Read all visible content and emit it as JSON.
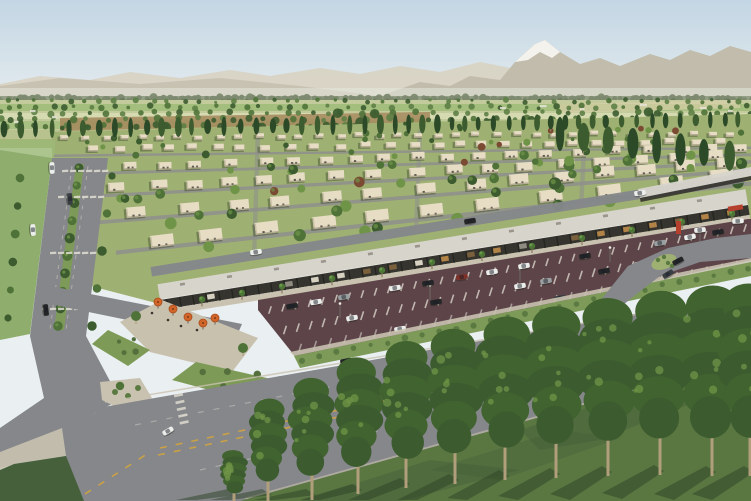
{
  "meta": {
    "title": "Aerial 3D rendering of a master-planned desert community with homes, tree-lined boulevard, retail strip and mountains",
    "type": "architectural-visualization"
  },
  "palette": {
    "sky_top": "#c3d6e3",
    "sky_horizon": "#eaeff1",
    "mtn_far": "#d8d3c4",
    "mtn_near": "#c1bcab",
    "snow": "#f4f2ec",
    "haze": "#e3e7dd",
    "treeline": "#7d8a6f",
    "treeline_dark": "#6d7c60",
    "field_light": "#c3cb9c",
    "field_green": "#9cba77",
    "field_pale": "#d8dcb4",
    "field_tan": "#d8cfa9",
    "field_brown": "#a3875c",
    "lawn": "#9fb172",
    "tree_dark": "#3c5c30",
    "tree_mid": "#4f7239",
    "tree_light": "#6f9447",
    "tree_red": "#7a4a33",
    "house": "#e7ddc5",
    "house_shade": "#b5ab92",
    "house_wall": "#c9bfa6",
    "opening": "#4b4a40",
    "street": "#8f918b",
    "road": "#85878a",
    "road_dark": "#74767a",
    "sidewalk": "#c9c2b0",
    "plaza": "#c8c1ae",
    "lane_yellow": "#d2a43e",
    "marking_white": "#e2ded2",
    "roof": "#d7d4cc",
    "roof_edge": "#ecebe3",
    "fascia": "#35342f",
    "column": "#23231f",
    "glow": "#bf8c4a",
    "parking": "#5d4449",
    "median_green": "#7d9a58",
    "shrub": "#5b7a42",
    "shrub_bed": "#7e9a57",
    "grass_fg": "#5a7742",
    "grass_fg_dark": "#45603a",
    "shadow_green": "#2c4123",
    "umbrella": "#d2662a",
    "umbrella_dark": "#a84d1d",
    "trunk": "#b19f7c",
    "palm_green": "#4d7636",
    "pole": "#d8d8d0",
    "car_white": "#eceeec",
    "car_black": "#232526",
    "car_gray": "#9aa0a2",
    "car_red": "#7e3129",
    "car_slate": "#3a3f44",
    "monument_red": "#b5402e",
    "people": "#3a352e"
  },
  "scene": {
    "house_rows": [
      {
        "y": 135,
        "x0": 60,
        "x1": 748,
        "w": 8,
        "h": 4.5,
        "slope": -0.006
      },
      {
        "y": 146,
        "x0": 88,
        "x1": 748,
        "w": 10,
        "h": 6,
        "slope": -0.012
      },
      {
        "y": 163,
        "x0": 92,
        "x1": 748,
        "w": 13,
        "h": 7.5,
        "slope": -0.03
      },
      {
        "y": 184,
        "x0": 108,
        "x1": 748,
        "w": 16,
        "h": 9,
        "slope": -0.055
      },
      {
        "y": 208,
        "x0": 126,
        "x1": 748,
        "w": 19,
        "h": 10.5,
        "slope": -0.085
      },
      {
        "y": 236,
        "x0": 150,
        "x1": 742,
        "w": 23,
        "h": 12,
        "slope": -0.115
      }
    ],
    "cross_streets": [
      258,
      420,
      585
    ],
    "yard_tree_count": 85,
    "poplar_rows": [
      {
        "x0": 4,
        "x1": 445,
        "y": 129,
        "dydx": -0.012,
        "step": 13,
        "rx": 2.8,
        "ry": 8.5
      },
      {
        "x0": 452,
        "x1": 748,
        "y": 124,
        "dydx": -0.016,
        "step": 12,
        "rx": 2.6,
        "ry": 7
      },
      {
        "x0": 560,
        "x1": 748,
        "y": 134,
        "dydx": 0.128,
        "step": 23,
        "rx": 4.6,
        "ry": 15
      }
    ],
    "parking_rows": [
      {
        "x0": 270,
        "y0": 310,
        "x1": 745,
        "y1": 228,
        "stripes": 36,
        "len": 8
      },
      {
        "x0": 285,
        "y0": 330,
        "x1": 748,
        "y1": 244,
        "stripes": 36,
        "len": 9
      },
      {
        "x0": 300,
        "y0": 348,
        "x1": 751,
        "y1": 262,
        "stripes": 30,
        "len": 9
      }
    ],
    "parked_cars": [
      {
        "x": 292,
        "y": 306,
        "c": "car_black"
      },
      {
        "x": 316,
        "y": 302,
        "c": "car_white"
      },
      {
        "x": 344,
        "y": 297,
        "c": "car_gray"
      },
      {
        "x": 395,
        "y": 288,
        "c": "car_white"
      },
      {
        "x": 428,
        "y": 283,
        "c": "car_black"
      },
      {
        "x": 462,
        "y": 277,
        "c": "car_red"
      },
      {
        "x": 492,
        "y": 272,
        "c": "car_white"
      },
      {
        "x": 524,
        "y": 266,
        "c": "car_white"
      },
      {
        "x": 585,
        "y": 256,
        "c": "car_black"
      },
      {
        "x": 660,
        "y": 243,
        "c": "car_gray"
      },
      {
        "x": 690,
        "y": 237,
        "c": "car_white"
      },
      {
        "x": 718,
        "y": 232,
        "c": "car_black"
      },
      {
        "x": 352,
        "y": 318,
        "c": "car_white"
      },
      {
        "x": 436,
        "y": 302,
        "c": "car_black"
      },
      {
        "x": 520,
        "y": 286,
        "c": "car_white"
      },
      {
        "x": 546,
        "y": 281,
        "c": "car_gray"
      },
      {
        "x": 604,
        "y": 271,
        "c": "car_black"
      },
      {
        "x": 640,
        "y": 264,
        "c": "car_white"
      },
      {
        "x": 400,
        "y": 329,
        "c": "car_white"
      },
      {
        "x": 560,
        "y": 298,
        "c": "car_slate"
      }
    ],
    "road_cars": [
      {
        "x": 33,
        "y": 230,
        "a": 86,
        "c": "car_white"
      },
      {
        "x": 46,
        "y": 310,
        "a": 84,
        "c": "car_black"
      },
      {
        "x": 70,
        "y": 199,
        "a": 86,
        "c": "car_slate"
      },
      {
        "x": 52,
        "y": 168,
        "a": 88,
        "c": "car_white"
      },
      {
        "x": 256,
        "y": 252,
        "a": -9,
        "c": "car_white"
      },
      {
        "x": 470,
        "y": 221,
        "a": -9,
        "c": "car_black"
      },
      {
        "x": 640,
        "y": 193,
        "a": -9,
        "c": "car_white"
      },
      {
        "x": 678,
        "y": 261,
        "a": -28,
        "c": "car_black"
      },
      {
        "x": 668,
        "y": 274,
        "a": -32,
        "c": "car_slate"
      },
      {
        "x": 700,
        "y": 230,
        "a": -6,
        "c": "car_white"
      },
      {
        "x": 738,
        "y": 221,
        "a": -4,
        "c": "car_white"
      },
      {
        "x": 346,
        "y": 361,
        "a": -11,
        "c": "car_black"
      },
      {
        "x": 168,
        "y": 431,
        "a": -30,
        "c": "car_white"
      }
    ],
    "foreground_trees": [
      {
        "x": 234,
        "top": 452,
        "h": 52,
        "w": 24
      },
      {
        "x": 268,
        "top": 402,
        "h": 100,
        "w": 34
      },
      {
        "x": 312,
        "top": 382,
        "h": 118,
        "w": 40
      },
      {
        "x": 358,
        "top": 362,
        "h": 132,
        "w": 44
      },
      {
        "x": 406,
        "top": 346,
        "h": 142,
        "w": 47
      },
      {
        "x": 455,
        "top": 334,
        "h": 150,
        "w": 50
      },
      {
        "x": 505,
        "top": 322,
        "h": 158,
        "w": 52
      },
      {
        "x": 556,
        "top": 312,
        "h": 166,
        "w": 54
      },
      {
        "x": 608,
        "top": 304,
        "h": 172,
        "w": 56
      },
      {
        "x": 660,
        "top": 297,
        "h": 178,
        "w": 58
      },
      {
        "x": 712,
        "top": 292,
        "h": 184,
        "w": 60
      },
      {
        "x": 750,
        "top": 290,
        "h": 186,
        "w": 58
      }
    ],
    "umbrellas": [
      {
        "x": 158,
        "y": 302
      },
      {
        "x": 173,
        "y": 309
      },
      {
        "x": 188,
        "y": 317
      },
      {
        "x": 203,
        "y": 323
      },
      {
        "x": 215,
        "y": 318
      }
    ],
    "people": [
      {
        "x": 168,
        "y": 320
      },
      {
        "x": 181,
        "y": 326
      },
      {
        "x": 152,
        "y": 313
      },
      {
        "x": 197,
        "y": 330
      }
    ],
    "palms_x": [
      200,
      240,
      280,
      330,
      380,
      430,
      480,
      530,
      580,
      630,
      680,
      730
    ],
    "light_poles": [
      {
        "x": 340,
        "y": 318
      },
      {
        "x": 430,
        "y": 300
      },
      {
        "x": 520,
        "y": 282
      },
      {
        "x": 610,
        "y": 262
      },
      {
        "x": 700,
        "y": 243
      }
    ],
    "farm_buildings": [
      {
        "x": 30,
        "y": 110
      },
      {
        "x": 52,
        "y": 116
      },
      {
        "x": 14,
        "y": 121
      },
      {
        "x": 500,
        "y": 107
      },
      {
        "x": 540,
        "y": 105
      },
      {
        "x": 580,
        "y": 108
      },
      {
        "x": 640,
        "y": 104
      },
      {
        "x": 700,
        "y": 107
      },
      {
        "x": 728,
        "y": 110
      }
    ]
  }
}
